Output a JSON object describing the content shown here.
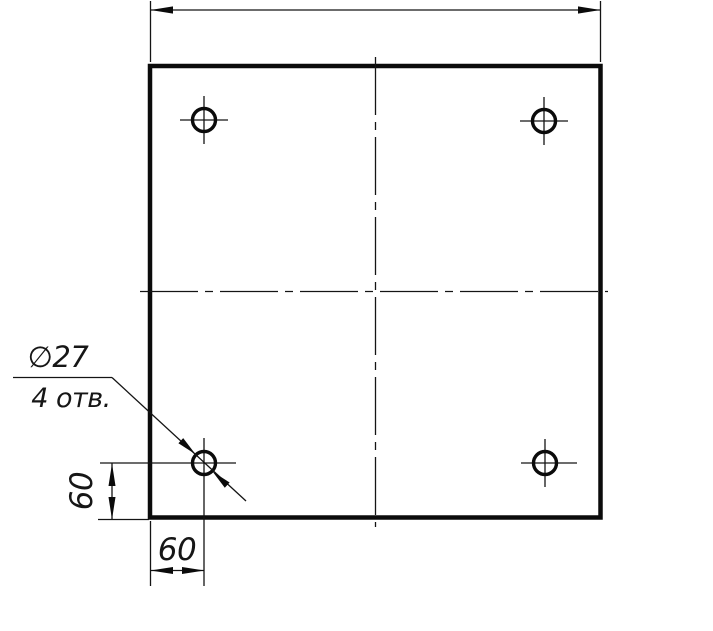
{
  "page": {
    "background_color": "#ffffff",
    "line_color": "#0b0b0b"
  },
  "drawing": {
    "kind": "engineering drawing — square plate with 4 through holes",
    "hole_count": 4,
    "labels": {
      "hole_diameter": "∅27",
      "hole_note": "4 отв.",
      "dim_left_vertical": "60",
      "dim_bottom_horizontal": "60"
    }
  }
}
